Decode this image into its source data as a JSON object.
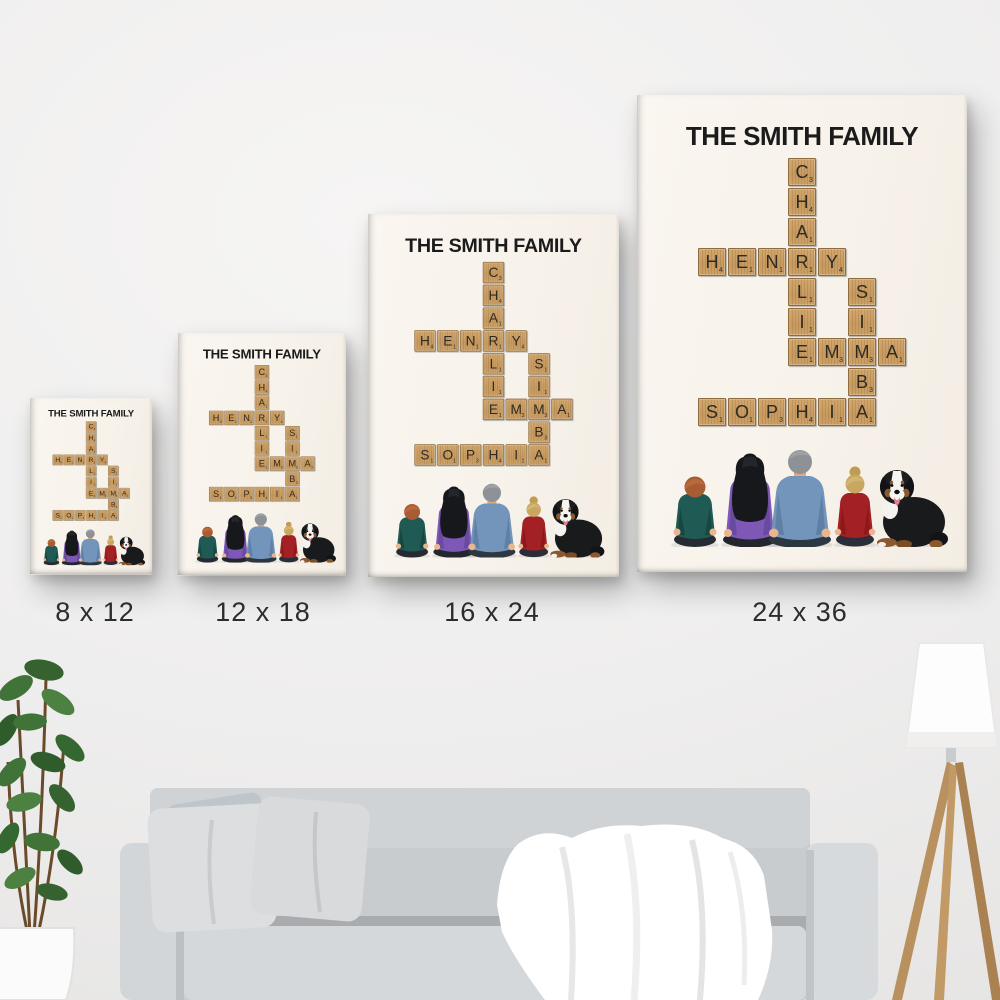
{
  "scene": {
    "description": "Four personalized scrabble-crossword family canvas prints on a wall above a gray sofa",
    "wall_color": "#f0efee",
    "sofa_color": "#ced1d3",
    "pillow_color": "#dcdee0",
    "blanket_color": "#ffffff",
    "plant_leaf_color": "#3e6e3a",
    "pot_color": "#fbfbfb",
    "lamp_shade_color": "#fdfdfd",
    "lamp_wood_color": "#b9915f"
  },
  "poster": {
    "title": "THE SMITH FAMILY",
    "background_color": "#f8f3ec",
    "title_color": "#1b1b1b",
    "tile_color": "#c99e66",
    "tile_letter_color": "#2e2a24",
    "names": [
      "CHARLIE",
      "HENRY",
      "SIMBA",
      "EMMA",
      "SOPHIA"
    ],
    "family_members": [
      "boy",
      "mom",
      "dad",
      "girl",
      "dog"
    ],
    "tiles": [
      {
        "row": 0,
        "col": 4,
        "letter": "C",
        "value": 3
      },
      {
        "row": 1,
        "col": 4,
        "letter": "H",
        "value": 4
      },
      {
        "row": 2,
        "col": 4,
        "letter": "A",
        "value": 1
      },
      {
        "row": 3,
        "col": 1,
        "letter": "H",
        "value": 4
      },
      {
        "row": 3,
        "col": 2,
        "letter": "E",
        "value": 1
      },
      {
        "row": 3,
        "col": 3,
        "letter": "N",
        "value": 1
      },
      {
        "row": 3,
        "col": 4,
        "letter": "R",
        "value": 1
      },
      {
        "row": 3,
        "col": 5,
        "letter": "Y",
        "value": 4
      },
      {
        "row": 4,
        "col": 4,
        "letter": "L",
        "value": 1
      },
      {
        "row": 4,
        "col": 6,
        "letter": "S",
        "value": 1
      },
      {
        "row": 5,
        "col": 4,
        "letter": "I",
        "value": 1
      },
      {
        "row": 5,
        "col": 6,
        "letter": "I",
        "value": 1
      },
      {
        "row": 6,
        "col": 4,
        "letter": "E",
        "value": 1
      },
      {
        "row": 6,
        "col": 5,
        "letter": "M",
        "value": 3
      },
      {
        "row": 6,
        "col": 6,
        "letter": "M",
        "value": 3
      },
      {
        "row": 6,
        "col": 7,
        "letter": "A",
        "value": 1
      },
      {
        "row": 7,
        "col": 6,
        "letter": "B",
        "value": 3
      },
      {
        "row": 8,
        "col": 1,
        "letter": "S",
        "value": 1
      },
      {
        "row": 8,
        "col": 2,
        "letter": "O",
        "value": 1
      },
      {
        "row": 8,
        "col": 3,
        "letter": "P",
        "value": 3
      },
      {
        "row": 8,
        "col": 4,
        "letter": "H",
        "value": 4
      },
      {
        "row": 8,
        "col": 5,
        "letter": "I",
        "value": 1
      },
      {
        "row": 8,
        "col": 6,
        "letter": "A",
        "value": 1
      }
    ]
  },
  "size_options": [
    {
      "label": "8 x 12"
    },
    {
      "label": "12 x 18"
    },
    {
      "label": "16 x 24"
    },
    {
      "label": "24 x 36"
    }
  ]
}
